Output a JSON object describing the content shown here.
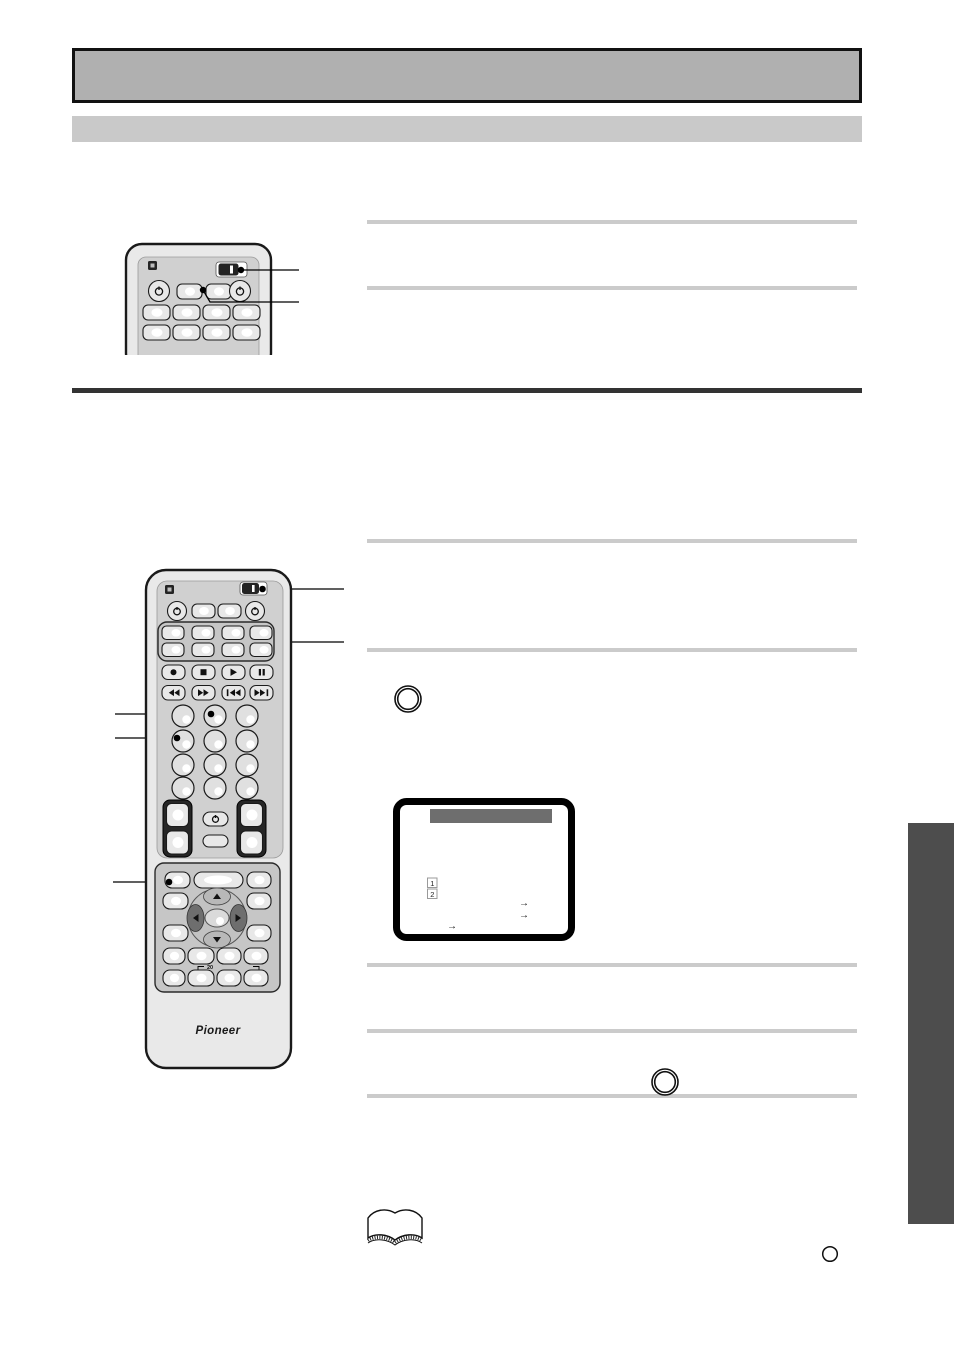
{
  "page": {
    "width": 954,
    "height": 1348,
    "background": "#ffffff"
  },
  "colors": {
    "header_box_fill": "#b0b0b0",
    "header_box_border": "#111111",
    "subheader_fill": "#c9c9c9",
    "text_rule": "#cbcbcb",
    "section_divider": "#333333",
    "side_tab": "#4d4d4d",
    "tv_menu_bar": "#6e6e6e",
    "remote_body": "#e9e9e9",
    "remote_panel": "#d0d0d0",
    "button_face": "#e8e8e8",
    "dark_parts": "#242424"
  },
  "remote_large": {
    "brand_label": "Pioneer",
    "numpad_bracket_label": "20"
  },
  "tv_screen": {
    "list_item_numbers": [
      "1",
      "2"
    ],
    "arrow_glyph": "→"
  },
  "icons": {
    "power": "⏻",
    "record": "●",
    "stop": "■",
    "play": "▶",
    "pause": "❚❚",
    "rewind": "◀◀",
    "fast_forward": "▶▶",
    "skip_back": "|◀◀",
    "skip_forward": "▶▶|",
    "arrow_up": "▲",
    "arrow_down": "▼",
    "arrow_left": "◀",
    "arrow_right": "▶",
    "mode_slider": "▭",
    "step_circle": "○",
    "open_book": "📖"
  }
}
